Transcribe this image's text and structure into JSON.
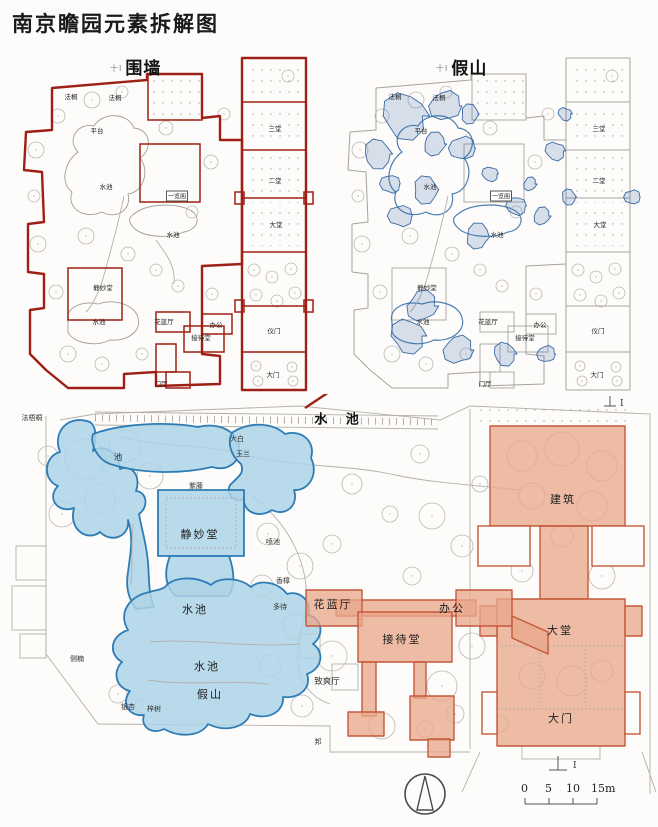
{
  "title": "南京瞻园元素拆解图",
  "panel_wall": {
    "header": "围墙",
    "mark": "十I"
  },
  "panel_rockery": {
    "header": "假山",
    "mark": "十I"
  },
  "top_plan_labels": [
    {
      "t": "法桐",
      "x": 65,
      "y": 42,
      "cls": "t"
    },
    {
      "t": "法桐",
      "x": 109,
      "y": 43,
      "cls": "t"
    },
    {
      "t": "平台",
      "x": 91,
      "y": 76,
      "cls": "t"
    },
    {
      "t": "水池",
      "x": 100,
      "y": 132,
      "cls": "t"
    },
    {
      "t": "一览阁",
      "x": 171,
      "y": 142,
      "cls": "t-box"
    },
    {
      "t": "水池",
      "x": 167,
      "y": 180,
      "cls": "t"
    },
    {
      "t": "静妙堂",
      "x": 97,
      "y": 233,
      "cls": "t"
    },
    {
      "t": "水池",
      "x": 93,
      "y": 267,
      "cls": "t"
    },
    {
      "t": "花蓝厅",
      "x": 158,
      "y": 267,
      "cls": "t"
    },
    {
      "t": "办公",
      "x": 210,
      "y": 270,
      "cls": "t"
    },
    {
      "t": "接待堂",
      "x": 195,
      "y": 283,
      "cls": "t"
    },
    {
      "t": "门厅",
      "x": 155,
      "y": 329,
      "cls": "t"
    },
    {
      "t": "三堂",
      "x": 269,
      "y": 74,
      "cls": "t"
    },
    {
      "t": "二堂",
      "x": 269,
      "y": 126,
      "cls": "t"
    },
    {
      "t": "大堂",
      "x": 270,
      "y": 170,
      "cls": "t"
    },
    {
      "t": "仪门",
      "x": 268,
      "y": 276,
      "cls": "t"
    },
    {
      "t": "大门",
      "x": 267,
      "y": 320,
      "cls": "t"
    }
  ],
  "bottom": {
    "labels": [
      {
        "t": "水 池",
        "x": 340,
        "y": 24,
        "cls": "lbl-big"
      },
      {
        "t": "法梧桐",
        "x": 32,
        "y": 24,
        "cls": "lbl-tiny"
      },
      {
        "t": "池",
        "x": 118,
        "y": 63,
        "cls": "lbl-med"
      },
      {
        "t": "大白",
        "x": 237,
        "y": 45,
        "cls": "lbl-tiny"
      },
      {
        "t": "玉兰",
        "x": 243,
        "y": 60,
        "cls": "lbl-tiny"
      },
      {
        "t": "紫藤",
        "x": 196,
        "y": 92,
        "cls": "lbl-tiny"
      },
      {
        "t": "静妙堂",
        "x": 200,
        "y": 140,
        "cls": "lbl-hall"
      },
      {
        "t": "喷池",
        "x": 273,
        "y": 148,
        "cls": "lbl-tiny"
      },
      {
        "t": "香樟",
        "x": 283,
        "y": 187,
        "cls": "lbl-tiny"
      },
      {
        "t": "多待",
        "x": 280,
        "y": 213,
        "cls": "lbl-tiny"
      },
      {
        "t": "花蓝厅",
        "x": 333,
        "y": 210,
        "cls": "lbl-hall"
      },
      {
        "t": "办公",
        "x": 452,
        "y": 214,
        "cls": "lbl-hall"
      },
      {
        "t": "接待堂",
        "x": 402,
        "y": 245,
        "cls": "lbl-hall"
      },
      {
        "t": "致爽厅",
        "x": 327,
        "y": 287,
        "cls": "lbl-med"
      },
      {
        "t": "水池",
        "x": 195,
        "y": 215,
        "cls": "lbl-hall"
      },
      {
        "t": "水池",
        "x": 207,
        "y": 272,
        "cls": "lbl-hall"
      },
      {
        "t": "假山",
        "x": 210,
        "y": 300,
        "cls": "lbl-hall"
      },
      {
        "t": "侧楠",
        "x": 77,
        "y": 265,
        "cls": "lbl-tiny"
      },
      {
        "t": "银杏",
        "x": 128,
        "y": 313,
        "cls": "lbl-tiny"
      },
      {
        "t": "梓树",
        "x": 154,
        "y": 315,
        "cls": "lbl-tiny"
      },
      {
        "t": "邦",
        "x": 318,
        "y": 348,
        "cls": "lbl-tiny"
      },
      {
        "t": "建筑",
        "x": 563,
        "y": 105,
        "cls": "lbl-hall"
      },
      {
        "t": "大堂",
        "x": 560,
        "y": 236,
        "cls": "lbl-hall"
      },
      {
        "t": "大门",
        "x": 561,
        "y": 324,
        "cls": "lbl-hall"
      }
    ],
    "scale": {
      "ticks": [
        "0",
        "5",
        "10",
        "15m"
      ]
    },
    "section_mark": "I"
  },
  "colors": {
    "wall_red": "#9e2015",
    "rockery_blue": "#3a6aa6",
    "water_fill": "#add3e6",
    "water_stroke": "#2e7cb5",
    "building_fill": "#e9a88c",
    "building_stroke": "#c4593a",
    "base_grey": "#b3b0ab"
  }
}
